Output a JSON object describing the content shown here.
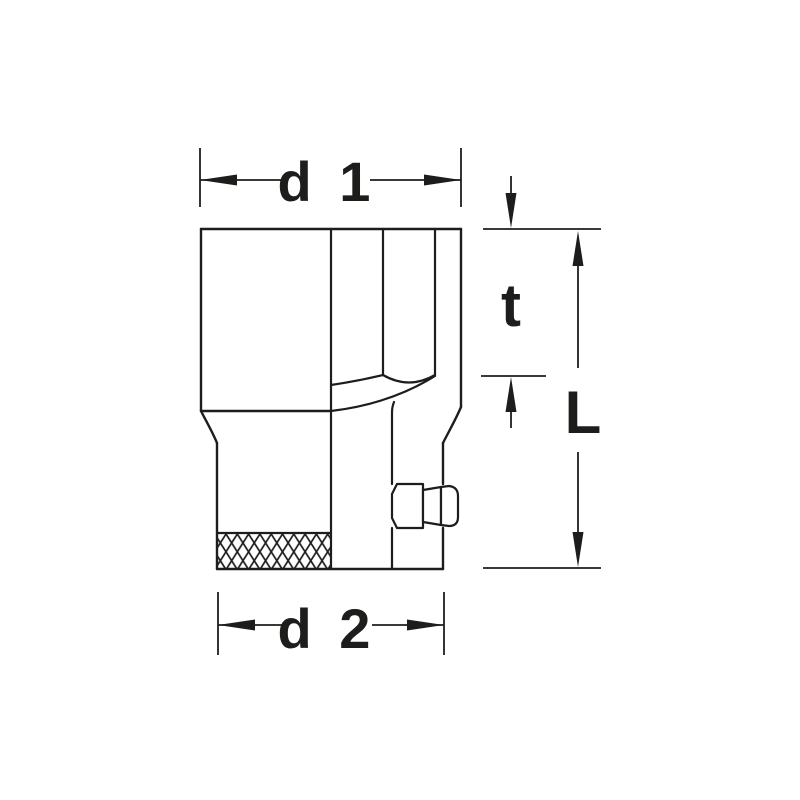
{
  "diagram": {
    "kind": "technical-dimension-drawing",
    "subject": "socket-wrench-side-view",
    "dimension_labels": {
      "d1": "d 1",
      "t": "t",
      "L": "L",
      "d2": "d 2"
    },
    "colors": {
      "line": "#1d1d1b",
      "background": "#ffffff"
    }
  }
}
